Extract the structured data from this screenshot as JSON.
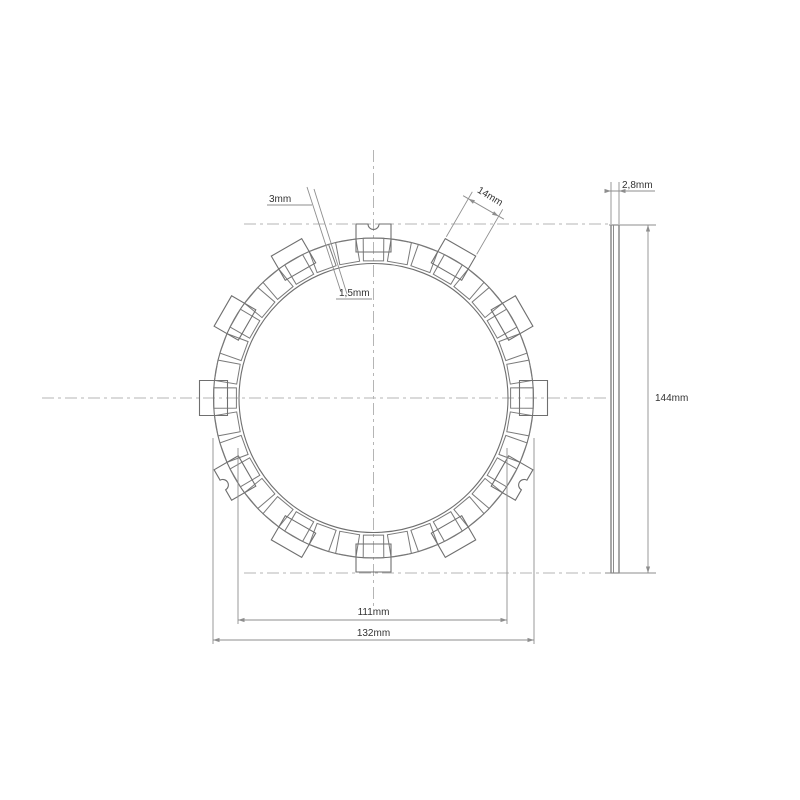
{
  "drawing_type": "clutch-friction-plate-technical-drawing",
  "colors": {
    "background": "#ffffff",
    "geometry_line": "#6f6f6f",
    "pad_line": "#7a7a7a",
    "dimension_line": "#8e8e8e",
    "centerline": "#b5b5b5",
    "text": "#333333"
  },
  "front_view": {
    "center_x": 373.5,
    "center_y": 398,
    "ring_outer_r": 160,
    "ring_inner_r": 134.5,
    "pad_inner_r": 137.5,
    "pad_count": 36,
    "pad_pitch_deg": 10,
    "pad_outer_half_deg": 3.69,
    "pad_inner_half_deg": 4.2,
    "tab_count": 12,
    "tab_step_deg": 30,
    "tab_inner_r": 146,
    "tab_outer_r": 174,
    "tab_width_px": 35,
    "notched_tab_angles": [
      90,
      210,
      330
    ],
    "notch_r": 5.5
  },
  "side_view": {
    "left": 611,
    "right": 619,
    "liner_x": 613.5,
    "top": 225,
    "bottom": 573
  },
  "centerlines": [
    {
      "name": "horizontal-centerline",
      "x1": 42,
      "y1": 398,
      "x2": 610,
      "y2": 398
    },
    {
      "name": "vertical-centerline",
      "x1": 373.5,
      "y1": 150,
      "x2": 373.5,
      "y2": 608
    },
    {
      "name": "top-tangent-centerline",
      "x1": 244,
      "y1": 224,
      "x2": 609,
      "y2": 224
    },
    {
      "name": "bottom-tangent-centerline",
      "x1": 244,
      "y1": 573,
      "x2": 606,
      "y2": 573
    }
  ],
  "dimensions": {
    "groove_outer": {
      "label": "3mm"
    },
    "groove_inner": {
      "label": "1,5mm"
    },
    "tab_width": {
      "label": "14mm"
    },
    "thickness": {
      "label": "2,8mm"
    },
    "overall_height": {
      "label": "144mm"
    },
    "inner_diameter": {
      "label": "111mm"
    },
    "outer_diameter": {
      "label": "132mm"
    }
  },
  "dim_geometry": {
    "leader_lines": [
      [
        307,
        187,
        341,
        292
      ],
      [
        314,
        189,
        347,
        294
      ]
    ],
    "underlines": [
      [
        267,
        205,
        312,
        205
      ],
      [
        336,
        299,
        372,
        299
      ]
    ],
    "inner_dia": {
      "ext": [
        [
          238,
          448,
          238,
          624
        ],
        [
          507,
          448,
          507,
          624
        ]
      ],
      "line": [
        238,
        620,
        507,
        620
      ]
    },
    "outer_dia": {
      "ext": [
        [
          213,
          438,
          213,
          644
        ],
        [
          534,
          438,
          534,
          644
        ]
      ],
      "line": [
        213,
        640,
        534,
        640
      ]
    },
    "height": {
      "ext": [
        [
          609,
          225,
          656,
          225
        ],
        [
          605,
          573,
          656,
          573
        ]
      ],
      "line": [
        648,
        225,
        648,
        573
      ]
    },
    "thickness": {
      "ext": [
        [
          611,
          224,
          611,
          182
        ],
        [
          619,
          224,
          619,
          182
        ]
      ],
      "line": [
        605,
        191,
        655,
        191
      ]
    },
    "tab_dim": {
      "angle_deg": 60,
      "ext_r1": 176,
      "ext_r2": 228,
      "line_r": 220,
      "half_span": 17.5,
      "overshoot": 6
    }
  }
}
